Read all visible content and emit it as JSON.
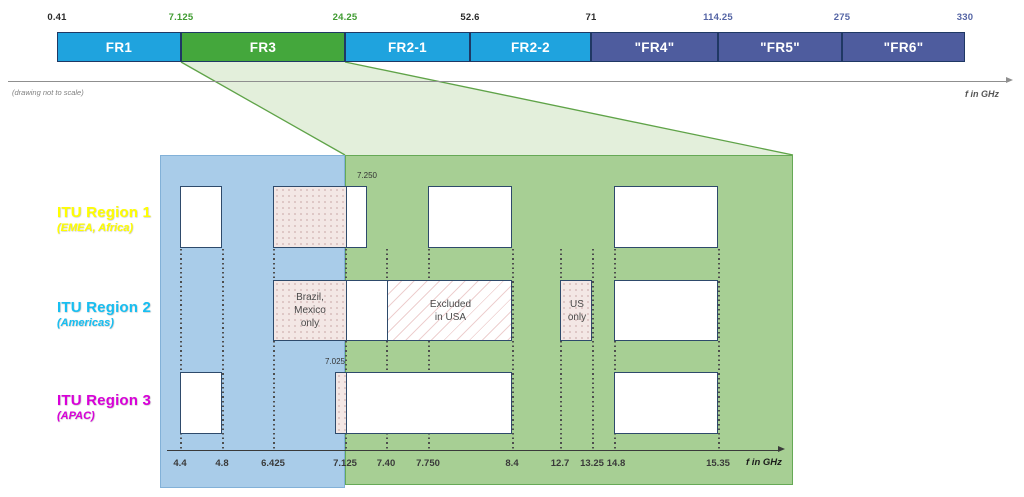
{
  "colors": {
    "band_blue": "#1FA3DE",
    "band_green": "#44A73C",
    "band_slate": "#4E5C9E",
    "band_border": "#1F3864",
    "tick_dark": "#2B2B2B",
    "tick_green": "#3F9B30",
    "tick_slate": "#5565A5",
    "overlay_blue": "#A9CCE9",
    "overlay_blue_border": "#82B1D8",
    "overlay_green": "#A7CF94",
    "overlay_green_border": "#66A956",
    "funnel_fill": "#DFEDD6",
    "funnel_line": "#5FA348",
    "box_border": "#2E4A6B",
    "axis_dark": "#3A3A3A",
    "region1_yellow": "#FFFF00",
    "region2_cyan": "#17BFF2",
    "region3_magenta": "#D900D9"
  },
  "top": {
    "note": "(drawing not to scale)",
    "axis_label": "f in GHz",
    "ticks": [
      {
        "text": "0.41",
        "x": 57,
        "color": "tick_dark"
      },
      {
        "text": "7.125",
        "x": 181,
        "color": "tick_green"
      },
      {
        "text": "24.25",
        "x": 345,
        "color": "tick_green"
      },
      {
        "text": "52.6",
        "x": 470,
        "color": "tick_dark"
      },
      {
        "text": "71",
        "x": 591,
        "color": "tick_dark"
      },
      {
        "text": "114.25",
        "x": 718,
        "color": "tick_slate"
      },
      {
        "text": "275",
        "x": 842,
        "color": "tick_slate"
      },
      {
        "text": "330",
        "x": 965,
        "color": "tick_slate"
      }
    ],
    "bands": [
      {
        "label": "FR1",
        "x1": 57,
        "x2": 181,
        "color": "band_blue"
      },
      {
        "label": "FR3",
        "x1": 181,
        "x2": 345,
        "color": "band_green"
      },
      {
        "label": "FR2-1",
        "x1": 345,
        "x2": 470,
        "color": "band_blue"
      },
      {
        "label": "FR2-2",
        "x1": 470,
        "x2": 591,
        "color": "band_blue"
      },
      {
        "label": "\"FR4\"",
        "x1": 591,
        "x2": 718,
        "color": "band_slate"
      },
      {
        "label": "\"FR5\"",
        "x1": 718,
        "x2": 842,
        "color": "band_slate"
      },
      {
        "label": "\"FR6\"",
        "x1": 842,
        "x2": 965,
        "color": "band_slate"
      }
    ]
  },
  "funnel": {
    "top_x1": 181,
    "top_x2": 345,
    "top_y": 62,
    "bottom_x1": 345,
    "bottom_x2": 793,
    "bottom_y": 155
  },
  "lower": {
    "blue_overlay": {
      "x1": 160,
      "x2": 345,
      "y1": 155,
      "y2": 488
    },
    "green_overlay": {
      "x1": 345,
      "x2": 793,
      "y1": 155,
      "y2": 485
    },
    "regions": [
      {
        "title": "ITU Region 1",
        "subtitle": "(EMEA, Africa)",
        "color": "region1_yellow",
        "y": 204
      },
      {
        "title": "ITU Region 2",
        "subtitle": "(Americas)",
        "color": "region2_cyan",
        "y": 299
      },
      {
        "title": "ITU Region 3",
        "subtitle": "(APAC)",
        "color": "region3_magenta",
        "y": 392
      }
    ],
    "rows": [
      {
        "region": "itu-region-1",
        "y": 186,
        "h": 62,
        "boxes": [
          {
            "x1": 180,
            "x2": 222,
            "segments": [
              {
                "fill": "white",
                "to": 222
              }
            ]
          },
          {
            "x1": 273,
            "x2": 367,
            "top_label": {
              "text": "7.250",
              "x": 367
            },
            "segments": [
              {
                "fill": "pink",
                "to": 345
              },
              {
                "fill": "white",
                "to": 367
              }
            ]
          },
          {
            "x1": 428,
            "x2": 512,
            "segments": [
              {
                "fill": "white",
                "to": 512
              }
            ]
          },
          {
            "x1": 614,
            "x2": 718,
            "segments": [
              {
                "fill": "white",
                "to": 718
              }
            ]
          }
        ]
      },
      {
        "region": "itu-region-2",
        "y": 280,
        "h": 61,
        "boxes": [
          {
            "x1": 273,
            "x2": 512,
            "segments": [
              {
                "fill": "pink",
                "to": 345,
                "label": "Brazil,\nMexico\nonly"
              },
              {
                "fill": "white",
                "to": 386
              },
              {
                "fill": "hatch",
                "to": 512,
                "label": "Excluded\nin USA"
              }
            ]
          },
          {
            "x1": 560,
            "x2": 592,
            "segments": [
              {
                "fill": "pink",
                "to": 592,
                "label": "US\nonly"
              }
            ]
          },
          {
            "x1": 614,
            "x2": 718,
            "segments": [
              {
                "fill": "white",
                "to": 718
              }
            ]
          }
        ]
      },
      {
        "region": "itu-region-3",
        "y": 372,
        "h": 62,
        "boxes": [
          {
            "x1": 180,
            "x2": 222,
            "segments": [
              {
                "fill": "white",
                "to": 222
              }
            ]
          },
          {
            "x1": 335,
            "x2": 512,
            "top_label": {
              "text": "7.025",
              "x": 335
            },
            "segments": [
              {
                "fill": "pink",
                "to": 345
              },
              {
                "fill": "white",
                "to": 512
              }
            ]
          },
          {
            "x1": 614,
            "x2": 718,
            "segments": [
              {
                "fill": "white",
                "to": 718
              }
            ]
          }
        ]
      }
    ],
    "dotted_x": [
      180,
      222,
      273,
      345,
      386,
      428,
      512,
      560,
      592,
      614,
      718
    ],
    "axis": {
      "label": "f in GHz",
      "ticks": [
        {
          "text": "4.4",
          "x": 180
        },
        {
          "text": "4.8",
          "x": 222
        },
        {
          "text": "6.425",
          "x": 273
        },
        {
          "text": "7.125",
          "x": 345
        },
        {
          "text": "7.40",
          "x": 386
        },
        {
          "text": "7.750",
          "x": 428
        },
        {
          "text": "8.4",
          "x": 512
        },
        {
          "text": "12.7",
          "x": 560
        },
        {
          "text": "13.25",
          "x": 592
        },
        {
          "text": "14.8",
          "x": 616
        },
        {
          "text": "15.35",
          "x": 718
        }
      ]
    }
  }
}
